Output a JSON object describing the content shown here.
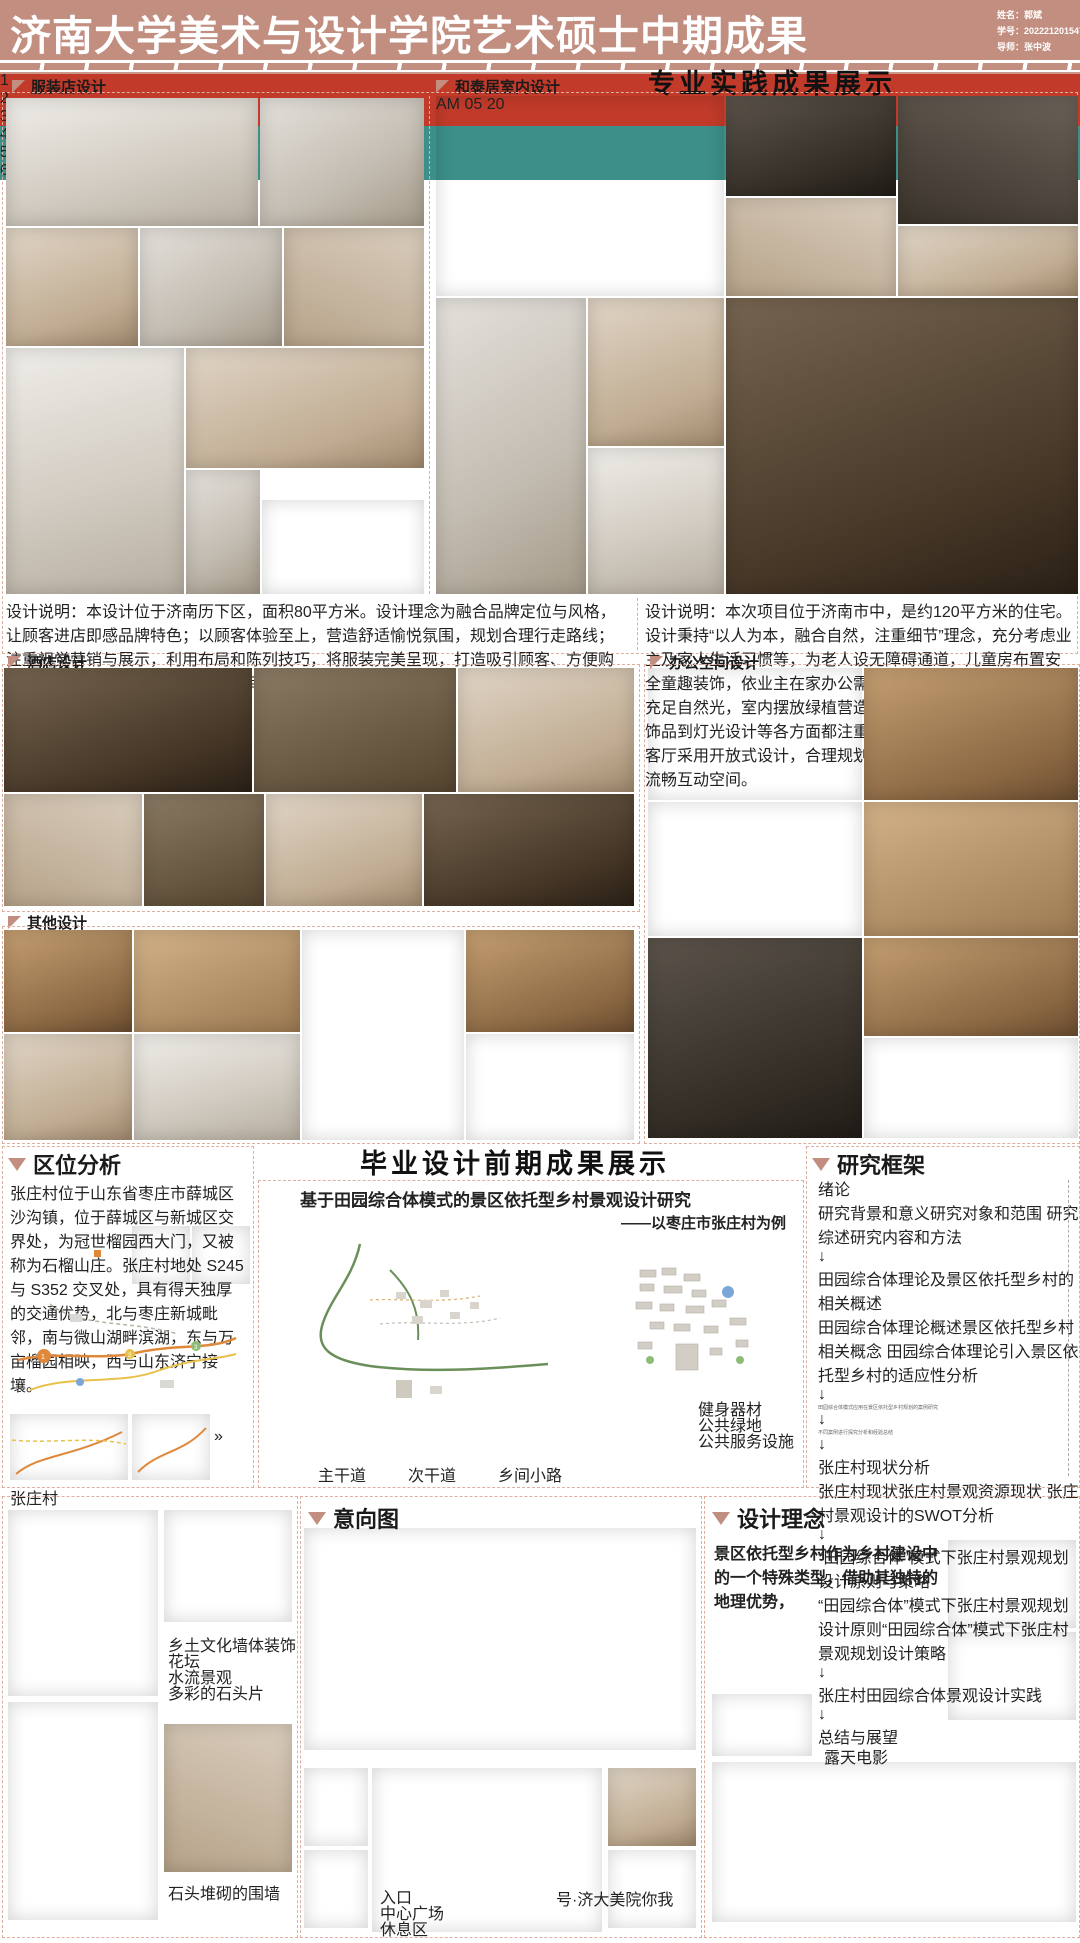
{
  "header": {
    "title": "济南大学美术与设计学院艺术硕士中期成果",
    "info1": "姓名：郭斌",
    "info2": "学号：202221201547",
    "info3": "导师：张中波"
  },
  "headings": {
    "practice": "专业实践成果展示",
    "graduation": "毕业设计前期成果展示"
  },
  "clothing": {
    "title": "服装店设计",
    "desc": "设计说明：本设计位于济南历下区，面积80平方米。设计理念为融合品牌定位与风格，让顾客进店即感品牌特色；以顾客体验至上，营造舒适愉悦氛围，规划合理行走路线；注重视觉营销与展示，利用布局和陈列技巧，将服装完美呈现，打造吸引顾客、方便购物且能充分展示商品的独特购物空间。"
  },
  "hetai": {
    "title": "和泰居室内设计",
    "tv_am": "AM",
    "tv_time": "05 20",
    "desc": "设计说明：本次项目位于济南市中，是约120平方米的住宅。设计秉持“以人为本，融合自然，注重细节”理念，充分考虑业主及家人生活习惯等，为老人设无障碍通道，儿童房布置安全童趣装饰，依业主在家办公需求打造书房；借落地窗引入充足自然光，室内摆放绿植营造自然惬意氛围；且从家具、饰品到灯光设计等各方面都注重细节，像客厅空间布局上，客厅采用开放式设计，合理规划沙发、茶几、电视区域形成流畅互动空间。"
  },
  "hotel": {
    "title": "酒店设计"
  },
  "office": {
    "title": "办公空间设计"
  },
  "other": {
    "title": "其他设计"
  },
  "location": {
    "title": "区位分析",
    "paragraph": "张庄村位于山东省枣庄市薛城区沙沟镇，位于薛城区与新城区交界处，为冠世榴园西大门，又被称为石榴山庄。张庄村地处 S245 与 S352 交叉处，具有得天独厚的交通优势，北与枣庄新城毗邻，南与微山湖畔滨湖，东与万亩榴园相映，西与山东济宁接壤。",
    "map_label": "张庄村"
  },
  "research": {
    "title": "基于田园综合体模式的景区依托型乡村景观设计研究",
    "subtitle": "——以枣庄市张庄村为例",
    "road_legend": [
      "主干道",
      "次干道",
      "乡间小路"
    ],
    "poi_legend": [
      "健身器材",
      "公共绿地",
      "公共服务设施"
    ]
  },
  "framework": {
    "title": "研究框架",
    "n_intro": "绪论",
    "r1": [
      "研究背景和意义",
      "研究对象和范围",
      "研究综述",
      "研究内容和方法"
    ],
    "n_theory": "田园综合体理论及景区依托型乡村的相关概述",
    "r2": [
      "田园综合体理论概述",
      "景区依托型乡村相关概念",
      "田园综合体理论引入景区依托型乡村的适应性分析"
    ],
    "t_case": "田园综合体模式应用在景区依托型乡村规划的案例研究",
    "t_sum": "不同案例进行探究分析和经验总结",
    "n_status": "张庄村现状分析",
    "r3": [
      "张庄村现状",
      "张庄村景观资源现状",
      "张庄村景观设计的SWOT分析"
    ],
    "n_principle": "“田园综合体”模式下张庄村景观规划设计原则与策略",
    "r4": [
      "“田园综合体”模式下张庄村景观规划设计原则",
      "“田园综合体”模式下张庄村景观规划设计策略"
    ],
    "n_practice": "张庄村田园综合体景观设计实践",
    "n_conclusion": "总结与展望",
    "stages": [
      "提出问题",
      "分析问题",
      "解决问题"
    ]
  },
  "intention": {
    "title": "意向图",
    "plan_labels": [
      "入口",
      "中心广场",
      "休息区"
    ]
  },
  "concept": {
    "title": "设计理念",
    "paragraph_start": "景区依托型乡村作为乡村建设中的一个特殊类型，借助其独特的地理优势，"
  },
  "village": {
    "captions": [
      "乡土文化墙体装饰",
      "花坛",
      "水流景观",
      "多彩的石头片"
    ],
    "caption_wall": "石头堆砌的围墙",
    "caption_movie": "露天电影"
  },
  "watermark": {
    "text": "号·济大美院你我"
  }
}
